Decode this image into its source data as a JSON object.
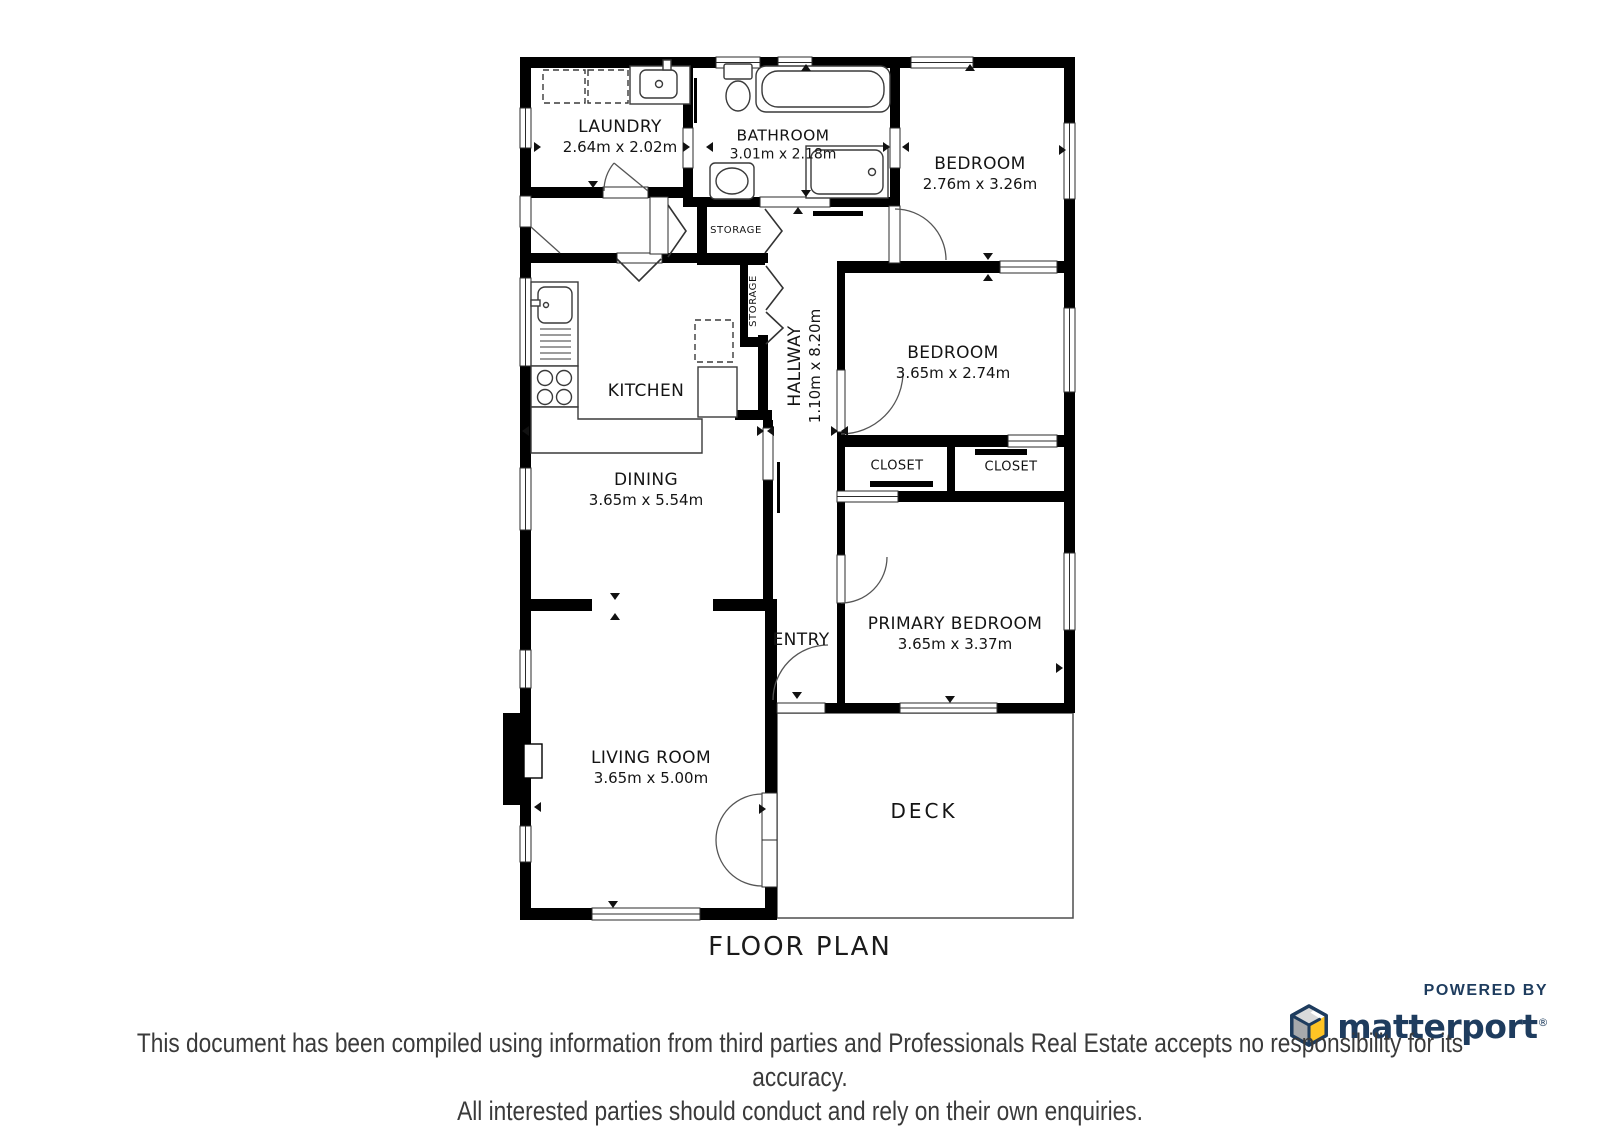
{
  "title": "FLOOR PLAN",
  "rooms": {
    "laundry": {
      "name": "LAUNDRY",
      "dims": "2.64m x 2.02m"
    },
    "bathroom": {
      "name": "BATHROOM",
      "dims": "3.01m x 2.18m"
    },
    "bedroom_top": {
      "name": "BEDROOM",
      "dims": "2.76m x 3.26m"
    },
    "bedroom_mid": {
      "name": "BEDROOM",
      "dims": "3.65m x 2.74m"
    },
    "primary_bedroom": {
      "name": "PRIMARY BEDROOM",
      "dims": "3.65m x 3.37m"
    },
    "kitchen": {
      "name": "KITCHEN"
    },
    "dining": {
      "name": "DINING",
      "dims": "3.65m x 5.54m"
    },
    "living_room": {
      "name": "LIVING ROOM",
      "dims": "3.65m x 5.00m"
    },
    "hallway": {
      "name": "HALLWAY",
      "dims": "1.10m x 8.20m"
    },
    "entry": {
      "name": "ENTRY"
    },
    "deck": {
      "name": "DECK"
    },
    "storage_upper": {
      "name": "STORAGE"
    },
    "storage_lower": {
      "name": "STORAGE"
    },
    "closet_left": {
      "name": "CLOSET"
    },
    "closet_right": {
      "name": "CLOSET"
    }
  },
  "branding": {
    "powered_by": "POWERED BY",
    "brand": "matterport",
    "registered": "®"
  },
  "disclaimer": {
    "line1": "This document has been compiled using information from third parties and Professionals Real Estate accepts no responsibility for its accuracy.",
    "line2": "All interested parties should conduct and rely on their own enquiries."
  },
  "colors": {
    "wall": "#000000",
    "brand_navy": "#1e3c5e",
    "brand_yellow": "#ffc425",
    "brand_gray": "#a7a9ac",
    "brand_light_gray": "#d9dadb"
  }
}
